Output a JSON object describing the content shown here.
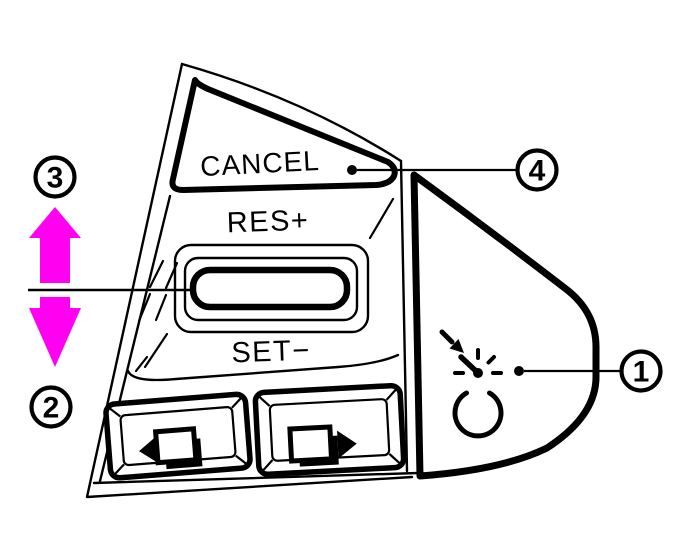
{
  "figure": {
    "background": "#ffffff",
    "line_color": "#000000",
    "arrow_color": "#ff00f0"
  },
  "labels": {
    "cancel": "CANCEL",
    "res_plus": "RES+",
    "set_minus": "SET−"
  },
  "callouts": {
    "c1": "1",
    "c2": "2",
    "c3": "3",
    "c4": "4"
  },
  "icons": {
    "cruise_control": "speedometer-gauge-with-pointer-arrow",
    "left_button": "screen-with-left-triangle",
    "right_button": "screen-with-right-triangle",
    "up_arrow": "magenta-up-arrow",
    "down_arrow": "magenta-down-arrow"
  }
}
